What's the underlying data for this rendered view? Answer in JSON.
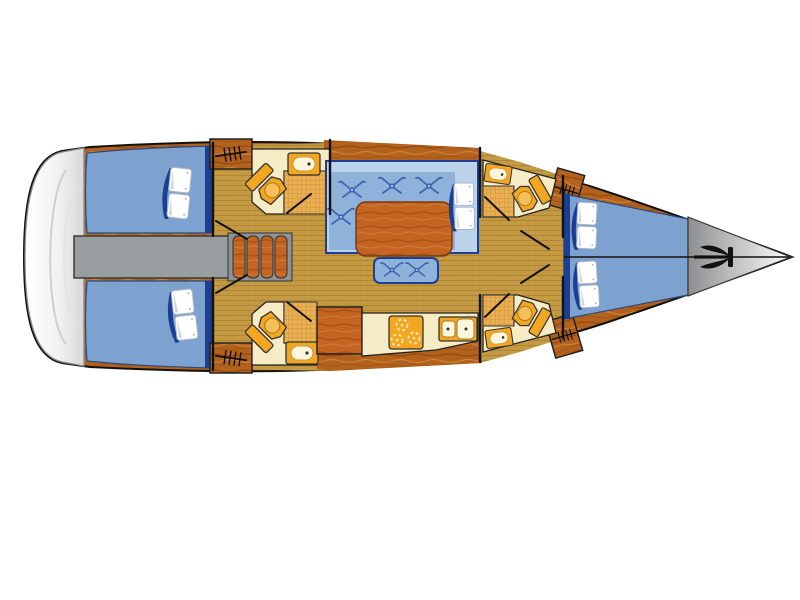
{
  "diagram": {
    "type": "floor-plan",
    "subject": "sailing-yacht-interior-layout-plan",
    "orientation": "bow-right-stern-left",
    "visible_text": [],
    "areas": [
      {
        "name": "swim-platform",
        "position": "stern"
      },
      {
        "name": "aft-cabin-port",
        "features": [
          "double-berth",
          "two-pillows"
        ]
      },
      {
        "name": "aft-cabin-starboard",
        "features": [
          "double-berth",
          "two-pillows"
        ]
      },
      {
        "name": "engine-compartment",
        "position": "between-aft-cabins"
      },
      {
        "name": "companionway-stairs",
        "steps": 4
      },
      {
        "name": "aft-head-port",
        "fixtures": [
          "toilet",
          "sink",
          "shower-grate"
        ]
      },
      {
        "name": "aft-head-starboard",
        "fixtures": [
          "toilet",
          "sink",
          "shower-grate"
        ]
      },
      {
        "name": "salon",
        "features": [
          "l-shaped-settee",
          "dining-table",
          "side-bench",
          "two-pillows"
        ],
        "cushion_buttons": 6
      },
      {
        "name": "galley",
        "fixtures": [
          "three-burner-stove",
          "double-sink",
          "wood-cabinet"
        ]
      },
      {
        "name": "forward-head-port",
        "fixtures": [
          "toilet",
          "sink",
          "shower-grate"
        ]
      },
      {
        "name": "forward-head-starboard",
        "fixtures": [
          "toilet",
          "sink",
          "shower-grate"
        ]
      },
      {
        "name": "hanging-lockers",
        "count": 4
      },
      {
        "name": "forward-cabin",
        "features": [
          "v-berth",
          "four-pillows",
          "centerline"
        ]
      },
      {
        "name": "anchor-locker",
        "icon": "anchor-icon",
        "position": "bow"
      }
    ]
  },
  "colors": {
    "hull_wood": "#b2621d",
    "wood_dark": "#96490f",
    "wood_light": "#cf8136",
    "wood_bright": "#c46322",
    "wood_bright_dark": "#a84f12",
    "floor_tan": "#c49a43",
    "floor_stripe": "#b08434",
    "cabin_blue": "#7ea2cf",
    "settee_blue": "#8fb2da",
    "backrest_blue": "#bad3ea",
    "navy": "#1c3f94",
    "mark_blue": "#3f63ad",
    "cream": "#f5ecc6",
    "cream_light": "#fdf6dd",
    "fixture_orange": "#f3a61f",
    "fixture_inner": "#f5c05a",
    "shower_bg": "#eaaf52",
    "shower_line": "#c68d32",
    "engine_gray": "#989da0",
    "stairs_gray": "#8e9397",
    "platform_shade": "#d8d8d8",
    "bow_dark": "#8e8e8e",
    "bow_light": "#fdfdfd",
    "line": "#111111",
    "pillow_shade": "#ccd6e2"
  }
}
